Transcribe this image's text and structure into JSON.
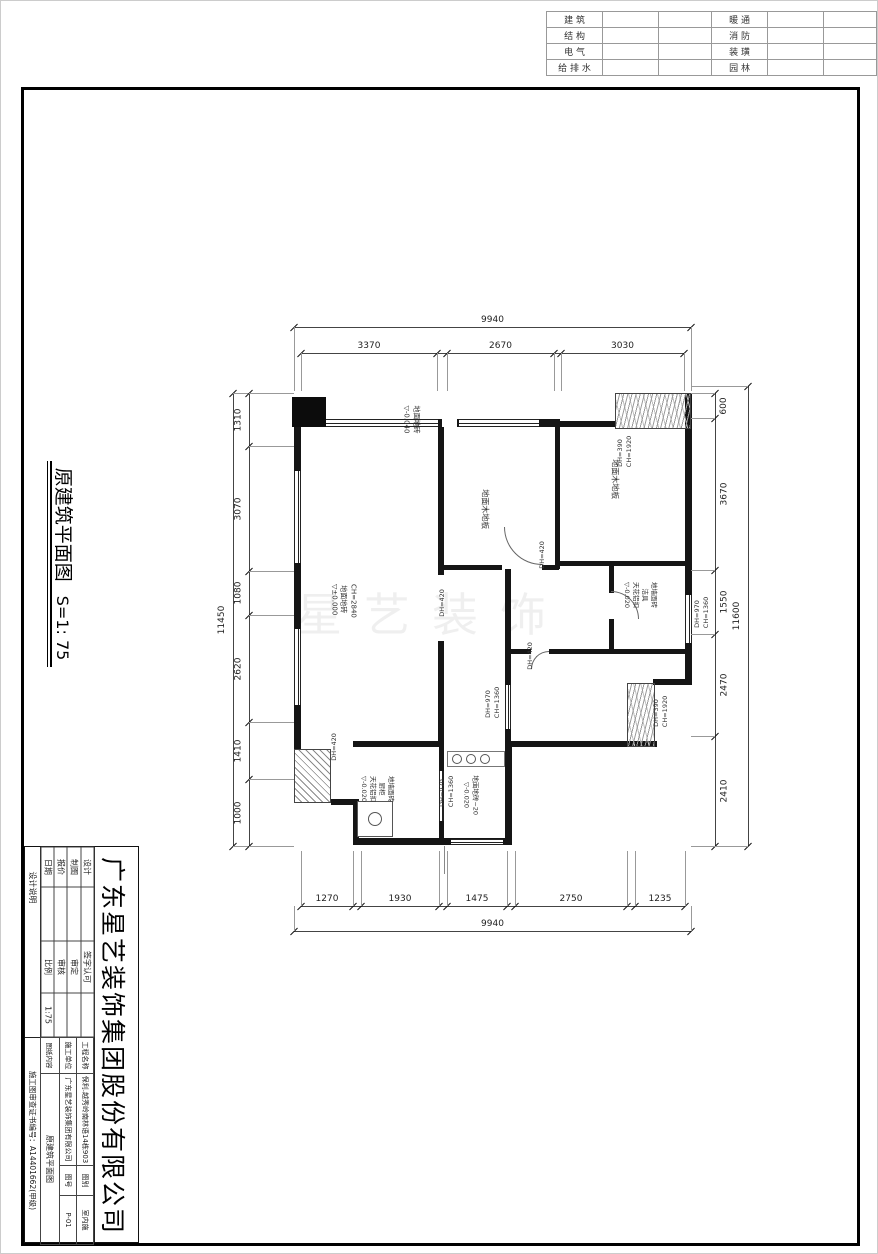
{
  "disciplines": {
    "left_labels": [
      "建 筑",
      "结 构",
      "电 气",
      "给 排 水"
    ],
    "right_labels": [
      "暖 通",
      "消 防",
      "装 璜",
      "园 林"
    ]
  },
  "sheet": {
    "title": "原建筑平面图",
    "scale": "S=1: 75",
    "watermark": "星艺装饰"
  },
  "title_block": {
    "company": "广东星艺装饰集团股份有限公司",
    "side_note": "设计说明",
    "cert": "施工图审查证书编号：A14401662(甲级)",
    "sign_table": {
      "rows": [
        [
          "设计",
          "",
          "签字认可",
          ""
        ],
        [
          "制图",
          "",
          "审定",
          ""
        ],
        [
          "报价",
          "",
          "审核",
          ""
        ],
        [
          "日期",
          "",
          "比例",
          "1:75"
        ]
      ]
    },
    "info_table": {
      "r1": [
        "工程名称",
        "保利.越秀岭南林语14栋903",
        "图别",
        "室内施"
      ],
      "r2": [
        "施工单位",
        "广东星艺装饰集团有限公司",
        "图号",
        "P-01"
      ],
      "r3": [
        "图纸内容",
        "原建筑平面图"
      ]
    }
  },
  "plan": {
    "labels": [
      {
        "cx": 410,
        "cy": 418,
        "rot": 90,
        "size": 7,
        "lines": [
          "地面地砖",
          "▽-0.040"
        ]
      },
      {
        "cx": 483,
        "cy": 508,
        "rot": 90,
        "size": 8,
        "lines": [
          "地面木地板"
        ]
      },
      {
        "cx": 613,
        "cy": 478,
        "rot": 90,
        "size": 8,
        "lines": [
          "地面木地板"
        ]
      },
      {
        "cx": 624,
        "cy": 452,
        "rot": -90,
        "size": 6.5,
        "lines": [
          "DH=390",
          "CH=1920"
        ]
      },
      {
        "cx": 342,
        "cy": 598,
        "rot": 90,
        "size": 7,
        "lines": [
          "CH=2840",
          "地面地砖",
          "▽±0.000"
        ]
      },
      {
        "cx": 639,
        "cy": 594,
        "rot": 90,
        "size": 6.5,
        "lines": [
          "地墙面砖",
          "洁具",
          "天花铝扣",
          "▽-0.020"
        ]
      },
      {
        "cx": 701,
        "cy": 613,
        "rot": -90,
        "size": 6.5,
        "lines": [
          "DH=970",
          "CH=1360"
        ]
      },
      {
        "cx": 492,
        "cy": 703,
        "rot": -90,
        "size": 6.5,
        "lines": [
          "DH=970",
          "CH=1360"
        ]
      },
      {
        "cx": 660,
        "cy": 712,
        "rot": -90,
        "size": 6.5,
        "lines": [
          "DH=390",
          "CH=1920"
        ]
      },
      {
        "cx": 376,
        "cy": 788,
        "rot": 90,
        "size": 6.5,
        "lines": [
          "地墙面砖",
          "厨柜",
          "天花铝扣",
          "▽-0.020"
        ]
      },
      {
        "cx": 446,
        "cy": 792,
        "rot": -90,
        "size": 6.5,
        "lines": [
          "DH=970",
          "CH=1360"
        ]
      },
      {
        "cx": 470,
        "cy": 794,
        "rot": 90,
        "size": 6.5,
        "lines": [
          "地面地砖~20",
          "▽-0.020"
        ]
      },
      {
        "cx": 541,
        "cy": 555,
        "rot": -90,
        "size": 6.5,
        "lines": [
          "DH=420"
        ]
      },
      {
        "cx": 441,
        "cy": 603,
        "rot": -90,
        "size": 6.5,
        "lines": [
          "DH=420"
        ]
      },
      {
        "cx": 529,
        "cy": 656,
        "rot": -90,
        "size": 6.5,
        "lines": [
          "DH=420"
        ]
      },
      {
        "cx": 333,
        "cy": 747,
        "rot": -90,
        "size": 6.5,
        "lines": [
          "DH=420"
        ]
      }
    ]
  },
  "dims": {
    "h_chains": [
      {
        "y": 326,
        "ext": 64,
        "segments": [
          {
            "a": 293,
            "b": 690,
            "label": "9940"
          }
        ]
      },
      {
        "y": 352,
        "ext": 38,
        "segments": [
          {
            "a": 300,
            "b": 436,
            "label": "3370"
          },
          {
            "a": 446,
            "b": 553,
            "label": "2670"
          },
          {
            "a": 560,
            "b": 683,
            "label": "3030"
          }
        ]
      },
      {
        "y": 905,
        "ext": -55,
        "segments": [
          {
            "a": 300,
            "b": 352,
            "label": "1270"
          },
          {
            "a": 360,
            "b": 438,
            "label": "1930"
          },
          {
            "a": 446,
            "b": 506,
            "label": "1475"
          },
          {
            "a": 514,
            "b": 626,
            "label": "2750"
          },
          {
            "a": 634,
            "b": 684,
            "label": "1235"
          }
        ]
      },
      {
        "y": 930,
        "ext": -25,
        "segments": [
          {
            "a": 293,
            "b": 690,
            "label": "9940"
          }
        ]
      }
    ],
    "v_chains": [
      {
        "x": 232,
        "ext": 61,
        "side": -1,
        "segments": [
          {
            "a": 392,
            "b": 845,
            "label": "11450"
          }
        ]
      },
      {
        "x": 248,
        "ext": 45,
        "side": -1,
        "segments": [
          {
            "a": 392,
            "b": 445,
            "label": "1310"
          },
          {
            "a": 445,
            "b": 570,
            "label": "3070"
          },
          {
            "a": 570,
            "b": 614,
            "label": "1080"
          },
          {
            "a": 614,
            "b": 721,
            "label": "2620"
          },
          {
            "a": 721,
            "b": 778,
            "label": "1410"
          },
          {
            "a": 778,
            "b": 845,
            "label": "1000"
          }
        ]
      },
      {
        "x": 714,
        "ext": -24,
        "side": 1,
        "segments": [
          {
            "a": 392,
            "b": 417,
            "label": "600"
          },
          {
            "a": 417,
            "b": 569,
            "label": "3670"
          },
          {
            "a": 569,
            "b": 633,
            "label": "1550"
          },
          {
            "a": 633,
            "b": 735,
            "label": "2470"
          },
          {
            "a": 735,
            "b": 845,
            "label": "2410"
          }
        ]
      },
      {
        "x": 747,
        "ext": -57,
        "side": -1,
        "segments": [
          {
            "a": 385,
            "b": 845,
            "label": "11600"
          }
        ]
      }
    ]
  }
}
